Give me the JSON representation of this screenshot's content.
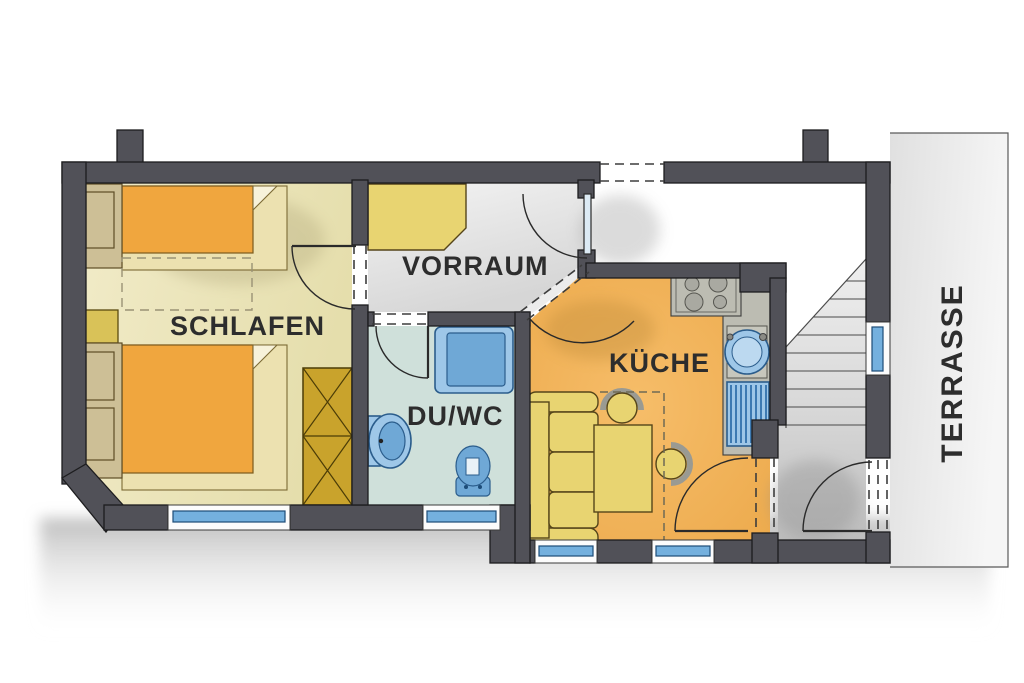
{
  "title": "Apartment floor plan",
  "rooms": [
    {
      "id": "schlafen",
      "label": "SCHLAFEN"
    },
    {
      "id": "vorraum",
      "label": "VORRAUM"
    },
    {
      "id": "du_wc",
      "label": "DU/WC"
    },
    {
      "id": "kueche",
      "label": "KÜCHE"
    },
    {
      "id": "terrasse",
      "label": "TERRASSE"
    }
  ],
  "colors": {
    "wall": "#515158",
    "label": "#2d2d2d",
    "floor_schlafen": "#efe9c2",
    "floor_vorraum": "#e9e9e9",
    "floor_duwc": "#cfe0da",
    "floor_kueche": "#f2b158",
    "floor_stairs": "#d9d9d9",
    "terrace": "#ededed",
    "bed": "#f0a63e",
    "bedbase": "#ece1b0",
    "headboard": "#cdbf96",
    "wardrobe": "#c9a32c",
    "furn": "#e8d471",
    "water": "#9ec7e8",
    "waterdark": "#6fa8d6",
    "glass": "#74b0de",
    "counter": "#bcbcb2"
  },
  "symbols": [
    "double-bed-upper",
    "double-bed-lower",
    "nightstand",
    "wardrobe",
    "hall-cabinet",
    "shower",
    "washbasin",
    "toilet",
    "cooktop",
    "kitchen-counter",
    "sink",
    "dish-drainer",
    "sofa",
    "dining-table",
    "chair",
    "chair",
    "stairs",
    "window",
    "door"
  ]
}
